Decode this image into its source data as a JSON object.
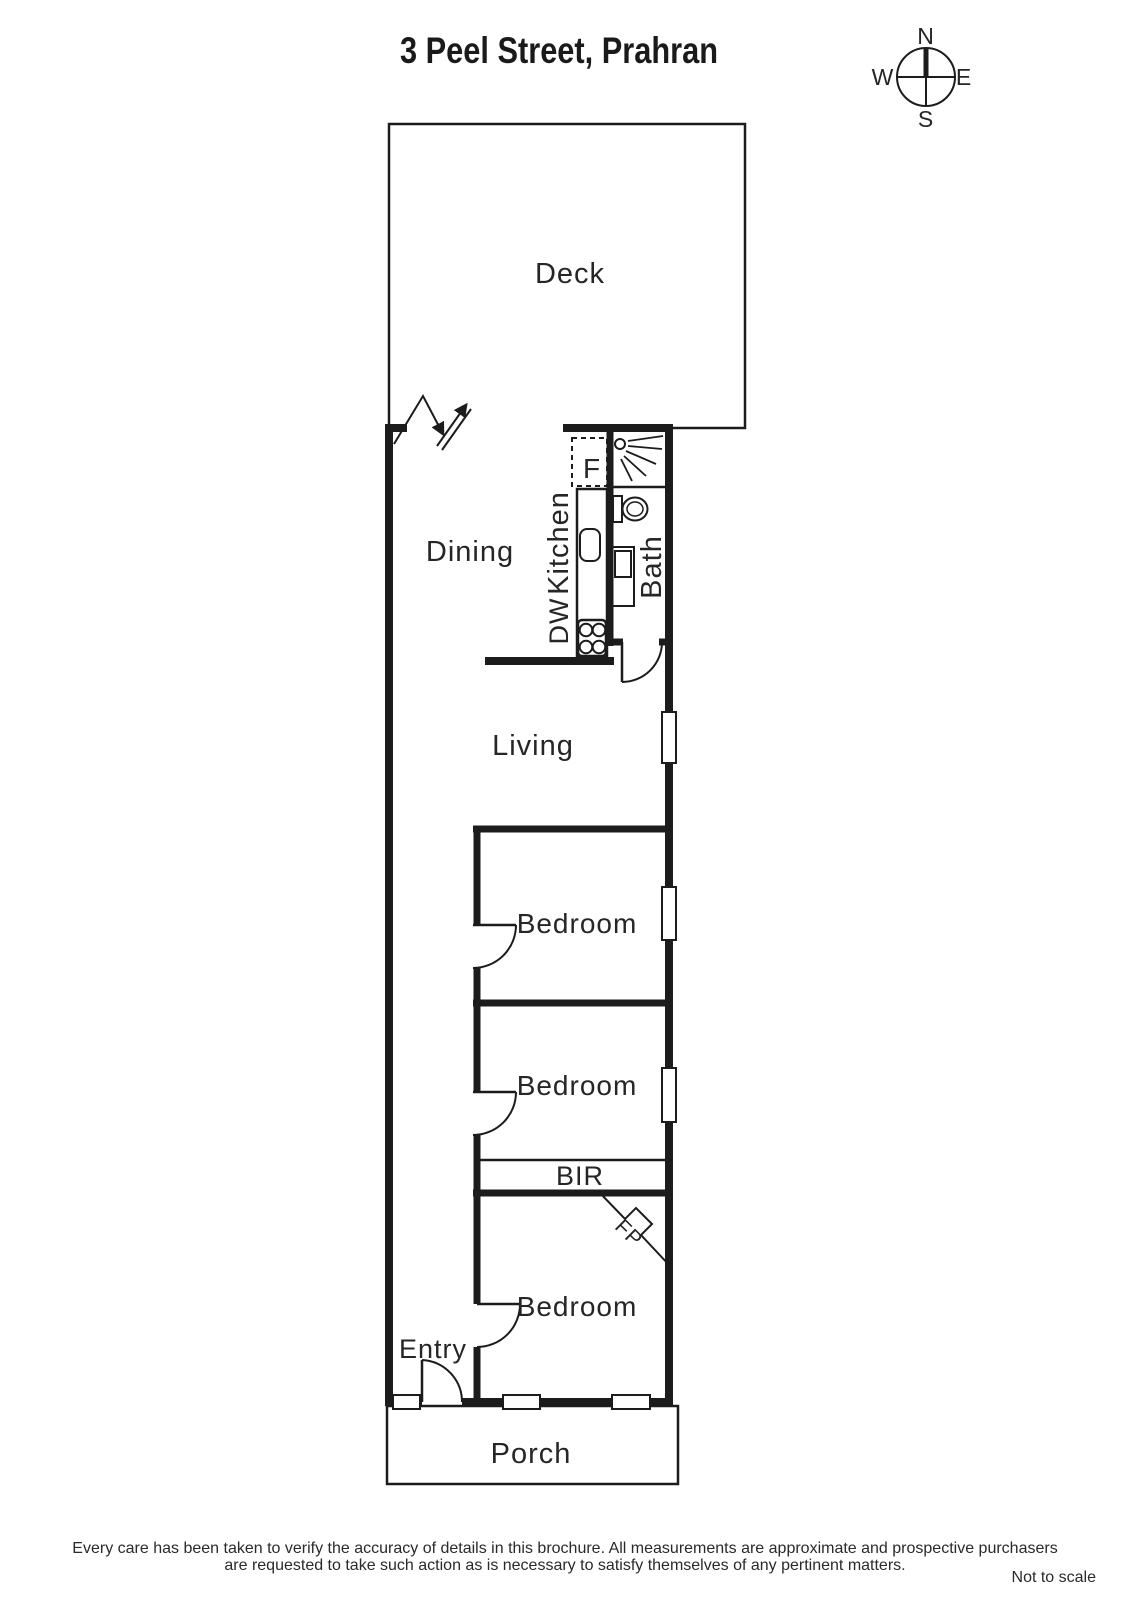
{
  "title": "3 Peel Street, Prahran",
  "compass": {
    "north": "N",
    "south": "S",
    "east": "E",
    "west": "W"
  },
  "rooms": {
    "deck": "Deck",
    "dining": "Dining",
    "kitchen": "Kitchen",
    "dishwasher": "DW",
    "fridge": "F",
    "bath": "Bath",
    "living": "Living",
    "bedroom_1": "Bedroom",
    "bedroom_2": "Bedroom",
    "bedroom_3": "Bedroom",
    "built_in_robe": "BIR",
    "fireplace": "FP",
    "entry": "Entry",
    "porch": "Porch"
  },
  "footer": {
    "disclaimer_line_1": "Every care has been taken to verify the accuracy of details in this brochure.  All measurements are approximate and prospective purchasers",
    "disclaimer_line_2": "are requested to take such action as is necessary to satisfy themselves of any pertinent matters.",
    "scale_note": "Not to scale"
  },
  "colors": {
    "ink": "#1c1c1c",
    "label": "#262626",
    "background": "#ffffff"
  }
}
